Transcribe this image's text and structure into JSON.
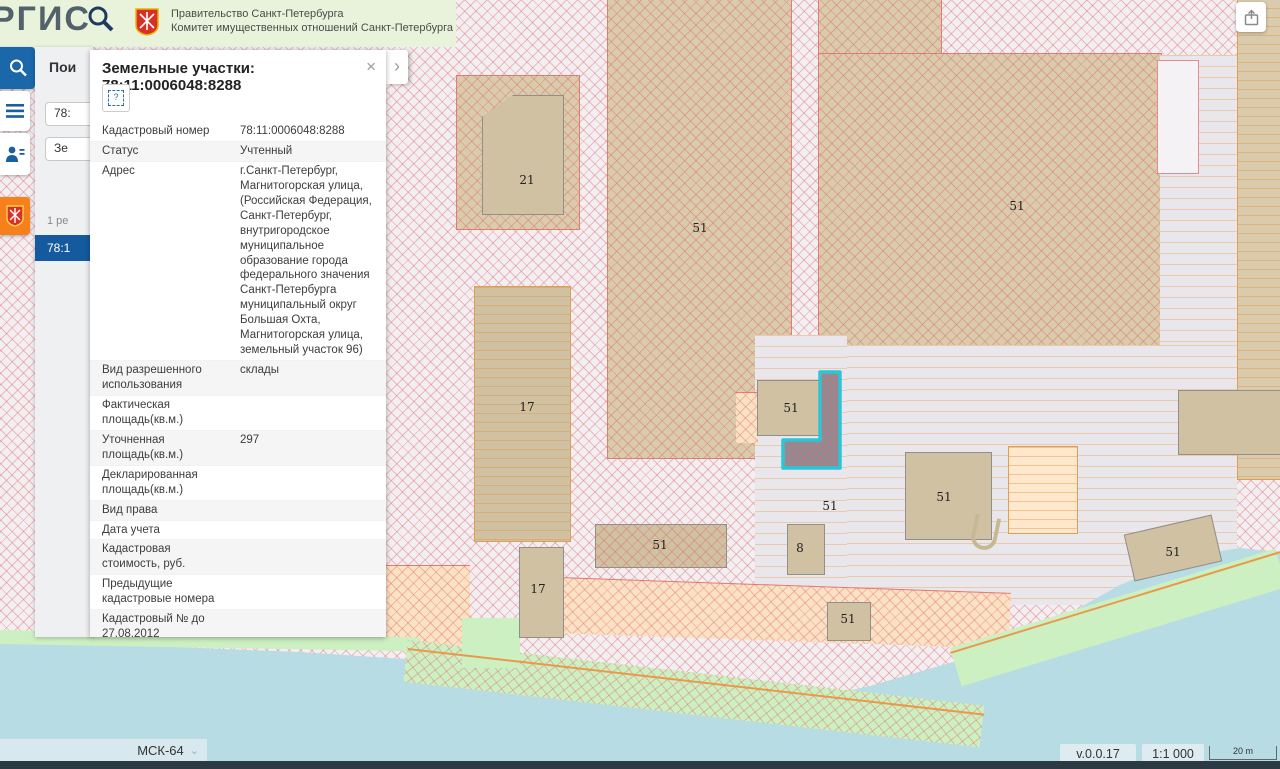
{
  "header": {
    "logo_text": "РГИС",
    "gov_line1": "Правительство Санкт-Петербурга",
    "gov_line2": "Комитет имущественных отношений Санкт-Петербурга"
  },
  "search_panel": {
    "title_clipped": "Пои",
    "field1_clipped": "78:",
    "field2_clipped": "Зе",
    "results_clipped": "1 ре",
    "selected_result_clipped": "78:1"
  },
  "popup": {
    "title": "Земельные участки: 78:11:0006048:8288",
    "close_label": "×",
    "expand_label": "›",
    "tool_icon_label": "?",
    "rows": [
      {
        "label": "Кадастровый номер",
        "value": "78:11:0006048:8288"
      },
      {
        "label": "Статус",
        "value": "Учтенный"
      },
      {
        "label": "Адрес",
        "value": "г.Санкт-Петербург, Магнитогорская улица, (Российская Федерация, Санкт-Петербург, внутригородское муниципальное образование города федерального значения Санкт-Петербурга муниципальный округ Большая Охта, Магнитогорская улица, земельный участок 96)"
      },
      {
        "label": "Вид разрешенного использования",
        "value": "склады"
      },
      {
        "label": "Фактическая площадь(кв.м.)",
        "value": ""
      },
      {
        "label": "Уточненная площадь(кв.м.)",
        "value": "297"
      },
      {
        "label": "Декларированная площадь(кв.м.)",
        "value": ""
      },
      {
        "label": "Вид права",
        "value": ""
      },
      {
        "label": "Дата учета",
        "value": ""
      },
      {
        "label": "Кадастровая стоимость, руб.",
        "value": ""
      },
      {
        "label": "Предыдущие кадастровые номера",
        "value": ""
      },
      {
        "label": "Кадастровый № до 27.08.2012",
        "value": ""
      },
      {
        "label": "Есть кадастровая съёмка?",
        "value": "Да"
      },
      {
        "label": "Информация об аренде",
        "value": "Не сдавался"
      }
    ]
  },
  "map": {
    "selected_parcel_outline_color": "#2bc6d6",
    "parcel_labels": [
      {
        "text": "21"
      },
      {
        "text": "51"
      },
      {
        "text": "51"
      },
      {
        "text": "17"
      },
      {
        "text": "51"
      },
      {
        "text": "51"
      },
      {
        "text": "51"
      },
      {
        "text": "8"
      },
      {
        "text": "51"
      },
      {
        "text": "17"
      },
      {
        "text": "51"
      },
      {
        "text": "51"
      }
    ]
  },
  "statusbar": {
    "crs": "МСК-64",
    "version": "v.0.0.17",
    "scale": "1:1 000",
    "scalebar_label": "20 m"
  }
}
